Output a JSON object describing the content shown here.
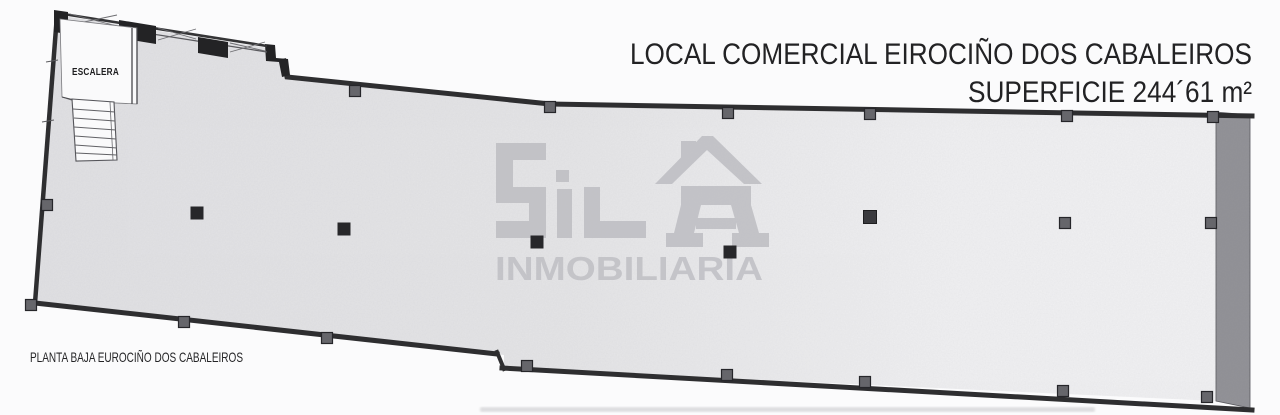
{
  "title": {
    "line1": "LOCAL COMERCIAL EIROCIÑO DOS CABALEIROS",
    "line2": "SUPERFICIE 244´61 m²"
  },
  "plan": {
    "stair_room_label": "ESCALERA",
    "caption": "PLANTA BAJA EUROCIÑO DOS CABALEIROS"
  },
  "watermark": {
    "brand": "SILA",
    "subtitle": "INMOBILIARIA"
  },
  "colors": {
    "title_text": "#222224",
    "caption_text": "#242426",
    "label_text": "#1c1c1e",
    "wall": "#2e2e30",
    "right_wall": "#8f8f94",
    "floor_light": "#e4e4e6",
    "watermark_gray": "#bfbfc4"
  }
}
